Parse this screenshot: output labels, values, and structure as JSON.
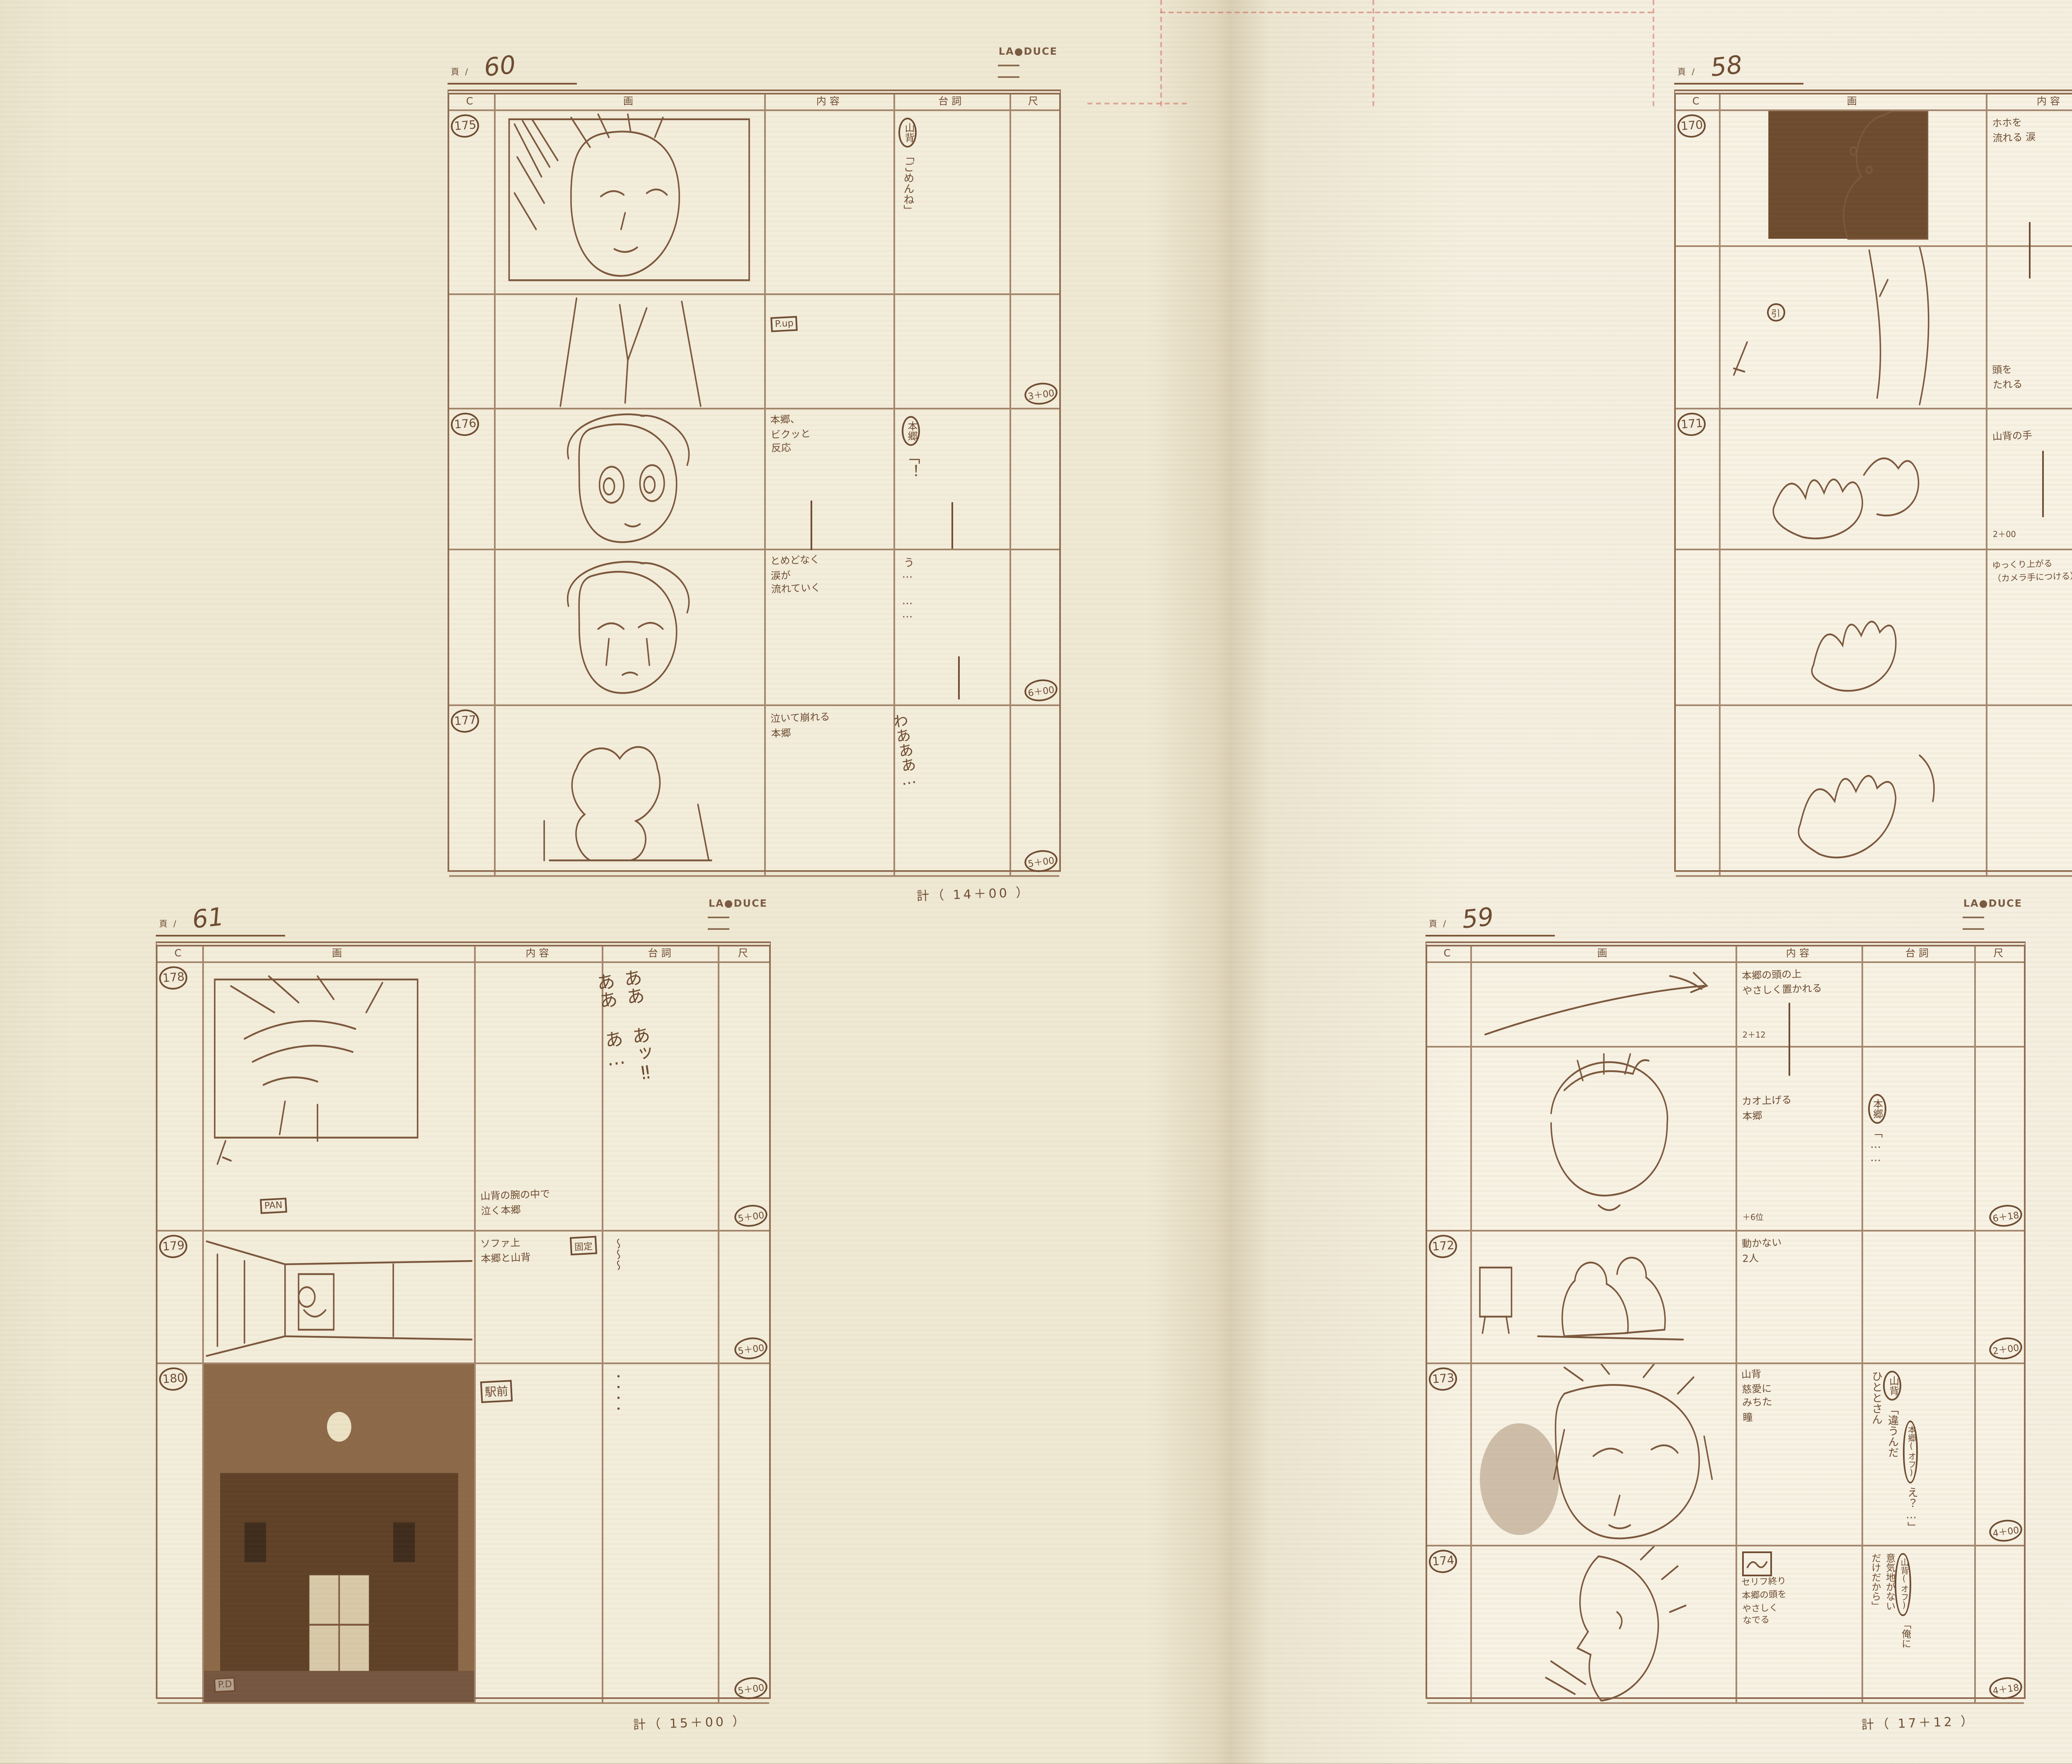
{
  "book": {
    "page_prefix": "頁 /",
    "logo": "LA●DUCE",
    "columns": [
      "C",
      "画",
      "内容",
      "台詞",
      "尺"
    ],
    "sheets": [
      {
        "page_no": "60",
        "total": "計（ 14＋00 ）",
        "rows": [
          {
            "cut": "175",
            "note": "P.up",
            "content": "",
            "dialogue_speaker": "山背",
            "dialogue": "「ごめんね」",
            "time": "3＋00"
          },
          {
            "cut": "176",
            "content": "本郷、\nビクッと\n反応",
            "dialogue_speaker": "本郷",
            "dialogue": "「！",
            "time": ""
          },
          {
            "cut": "",
            "content": "とめどなく\n涙が\n流れていく",
            "dialogue": "う… ……",
            "time": "6＋00"
          },
          {
            "cut": "177",
            "content": "泣いて崩れる\n本郷",
            "dialogue": "わあああ…",
            "time": "5＋00"
          }
        ]
      },
      {
        "page_no": "61",
        "total": "計（ 15＋00 ）",
        "rows": [
          {
            "cut": "178",
            "note": "PAN",
            "content": "山背の腕の中で\n泣く本郷",
            "dialogue": "ああ あッ‼\nああ あ…",
            "time": "5＋00"
          },
          {
            "cut": "179",
            "note": "固定",
            "content": "ソファ上\n本郷と山背",
            "dialogue": "〜〜〜",
            "time": "5＋00"
          },
          {
            "cut": "180",
            "note": "駅前",
            "note2": "P.D",
            "content": "",
            "dialogue": "・・・・",
            "time": "5＋00"
          }
        ]
      },
      {
        "page_no": "58",
        "total": "計（ 4＋18 ）",
        "rows": [
          {
            "cut": "170",
            "content": "ホホを\n流れる 涙",
            "dialogue_speaker": "本郷",
            "dialogue": "「教えて！",
            "time": ""
          },
          {
            "cut": "",
            "note": "引",
            "content": "頭を\nたれる",
            "dialogue": "教えてよ…",
            "time": "4＋18"
          },
          {
            "cut": "171",
            "content": "山背の手",
            "content2": "2＋00",
            "dialogue": "先生……」",
            "time": ""
          },
          {
            "cut": "",
            "content": "ゆっくり上がる\n（カメラ手につける）",
            "dialogue": "",
            "time": ""
          }
        ]
      },
      {
        "page_no": "59",
        "total": "計（ 17＋12 ）",
        "rows": [
          {
            "cut": "",
            "content": "本郷の頭の上\nやさしく置かれる",
            "content2": "2＋12",
            "dialogue": "",
            "time": ""
          },
          {
            "cut": "",
            "content": "カオ上げる\n本郷",
            "content2": "＋6位",
            "dialogue_speaker": "本郷",
            "dialogue": "「……",
            "time": "6＋18"
          },
          {
            "cut": "172",
            "content": "動かない\n2人",
            "dialogue": "",
            "time": "2＋00"
          },
          {
            "cut": "173",
            "content": "山背\n慈愛に\nみちた\n瞳",
            "dialogue_speaker": "山背",
            "dialogue": "「違うんだ\nひととさん",
            "dialogue2_speaker": "本郷(オフ)",
            "dialogue2": "え？…」",
            "time": "4＋00"
          },
          {
            "cut": "174",
            "content": "セリフ終り\n本郷の頭を\nやさしく\nなでる",
            "dialogue_speaker": "山背(オフ)",
            "dialogue": "「俺に\n意気地がない\nだけだから」",
            "time": "4＋18"
          }
        ]
      }
    ]
  }
}
